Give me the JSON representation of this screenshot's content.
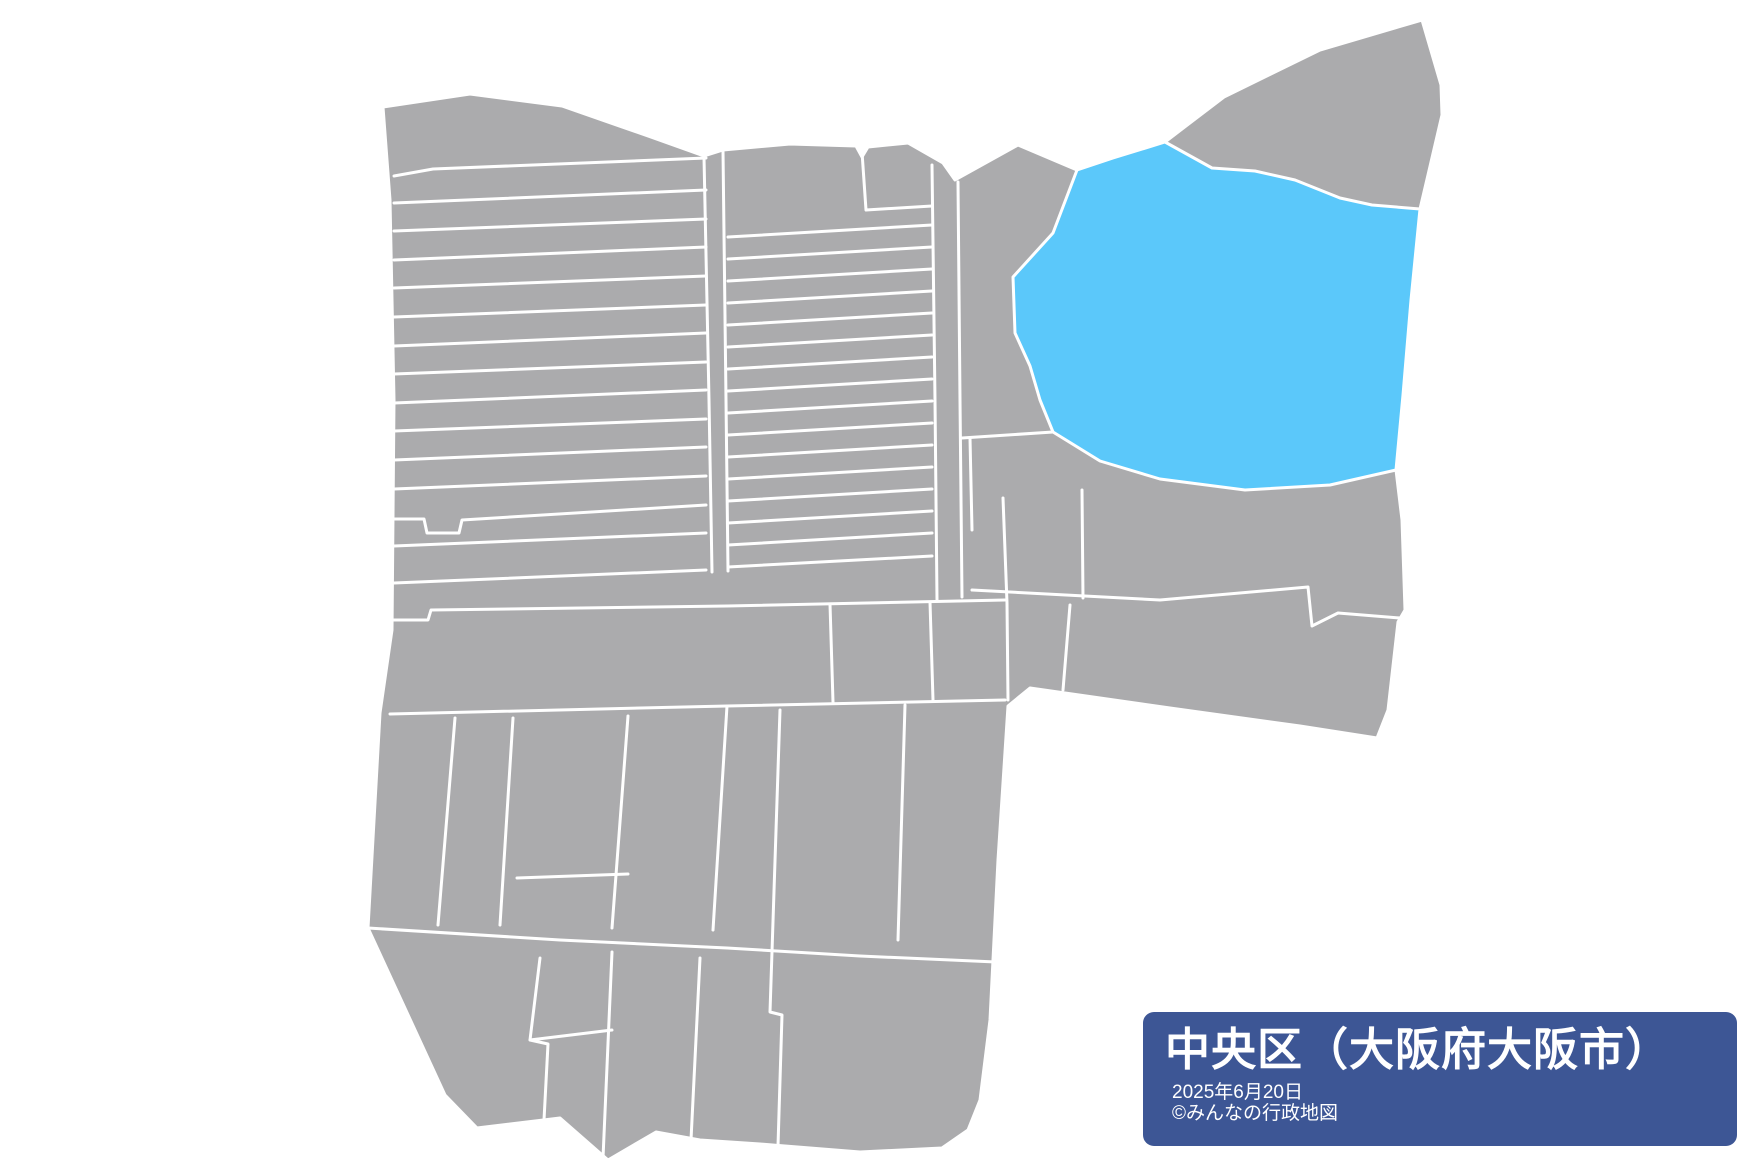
{
  "colors": {
    "background": "#ffffff",
    "region_fill": "#ababad",
    "region_border": "#ffffff",
    "highlight_fill": "#5bc8fa",
    "panel_bg": "#3d5695",
    "panel_text": "#ffffff"
  },
  "info_panel": {
    "title": "中央区（大阪府大阪市）",
    "date": "2025年6月20日",
    "copyright": "©みんなの行政地図"
  },
  "map": {
    "viewbox": "0 0 1760 1170",
    "border_width": 3,
    "silhouette": "383,107 470,94 562,106 648,136 704,156 723,150 790,144 856,146 862,157 868,147 908,143 943,163 955,180 1018,145 1077,170 1113,158 1165,142 1224,97 1320,50 1422,20 1441,85 1442,115 1428,175 1420,209 1411,300 1403,395 1396,470 1402,520 1405,610 1398,622 1388,710 1377,738 1300,726 1170,708 1030,688 1008,706 998,860 990,1020 980,1100 968,1130 942,1148 860,1152 760,1144 700,1140 656,1132 608,1160 560,1118 477,1128 445,1095 368,928 380,713 392,630 394,400 390,200",
    "highlight": "1165,142 1212,168 1255,171 1295,180 1340,198 1372,205 1420,209 1411,300 1403,395 1396,470 1330,485 1245,490 1160,479 1100,461 1053,432 1040,400 1030,366 1015,333 1013,277 1053,233 1077,170 1113,158",
    "borders": [
      "394,176 433,169 706,158",
      "394,203 706,190",
      "394,231 706,219",
      "394,260 706,247",
      "394,288 706,276",
      "394,317 706,305",
      "394,346 706,333",
      "394,374 706,362",
      "394,403 706,390",
      "394,431 706,419",
      "394,460 706,447",
      "394,489 706,476",
      "394,519 424,519 427,533 459,533 462,520 706,505",
      "394,546 706,533",
      "394,583 706,570",
      "704,157 709,400 712,572",
      "723,151 726,400 728,571",
      "392,620 428,620 431,610 727,606 1005,600",
      "390,714 727,706 1005,700",
      "862,152 866,210 932,206",
      "728,237 932,225",
      "728,259 932,247",
      "728,281 932,269",
      "728,303 932,291",
      "728,325 932,313",
      "728,347 932,335",
      "728,369 932,357",
      "728,391 932,379",
      "728,413 932,401",
      "728,435 932,423",
      "728,457 932,445",
      "728,479 932,467",
      "728,501 932,489",
      "728,523 932,511",
      "728,545 932,533",
      "728,567 932,556",
      "932,165 935,400 937,600",
      "958,182 960,400 962,597",
      "970,438 972,530",
      "962,438 1053,432",
      "830,604 833,702",
      "930,602 933,700",
      "455,718 438,925",
      "513,718 500,925",
      "628,716 612,928",
      "517,878 628,874",
      "727,706 713,930",
      "780,710 770,1012 782,1015 778,1146",
      "905,705 898,940",
      "368,928 560,940 727,948 860,956 996,962",
      "540,958 530,1040 548,1044 544,1120",
      "530,1040 612,1030",
      "612,952 603,1158",
      "700,958 691,1140",
      "1003,498 1007,603 1008,700",
      "972,590 1160,600 1308,587 1312,626 1338,613 1400,618",
      "1082,490 1083,598",
      "1070,605 1063,690"
    ]
  }
}
